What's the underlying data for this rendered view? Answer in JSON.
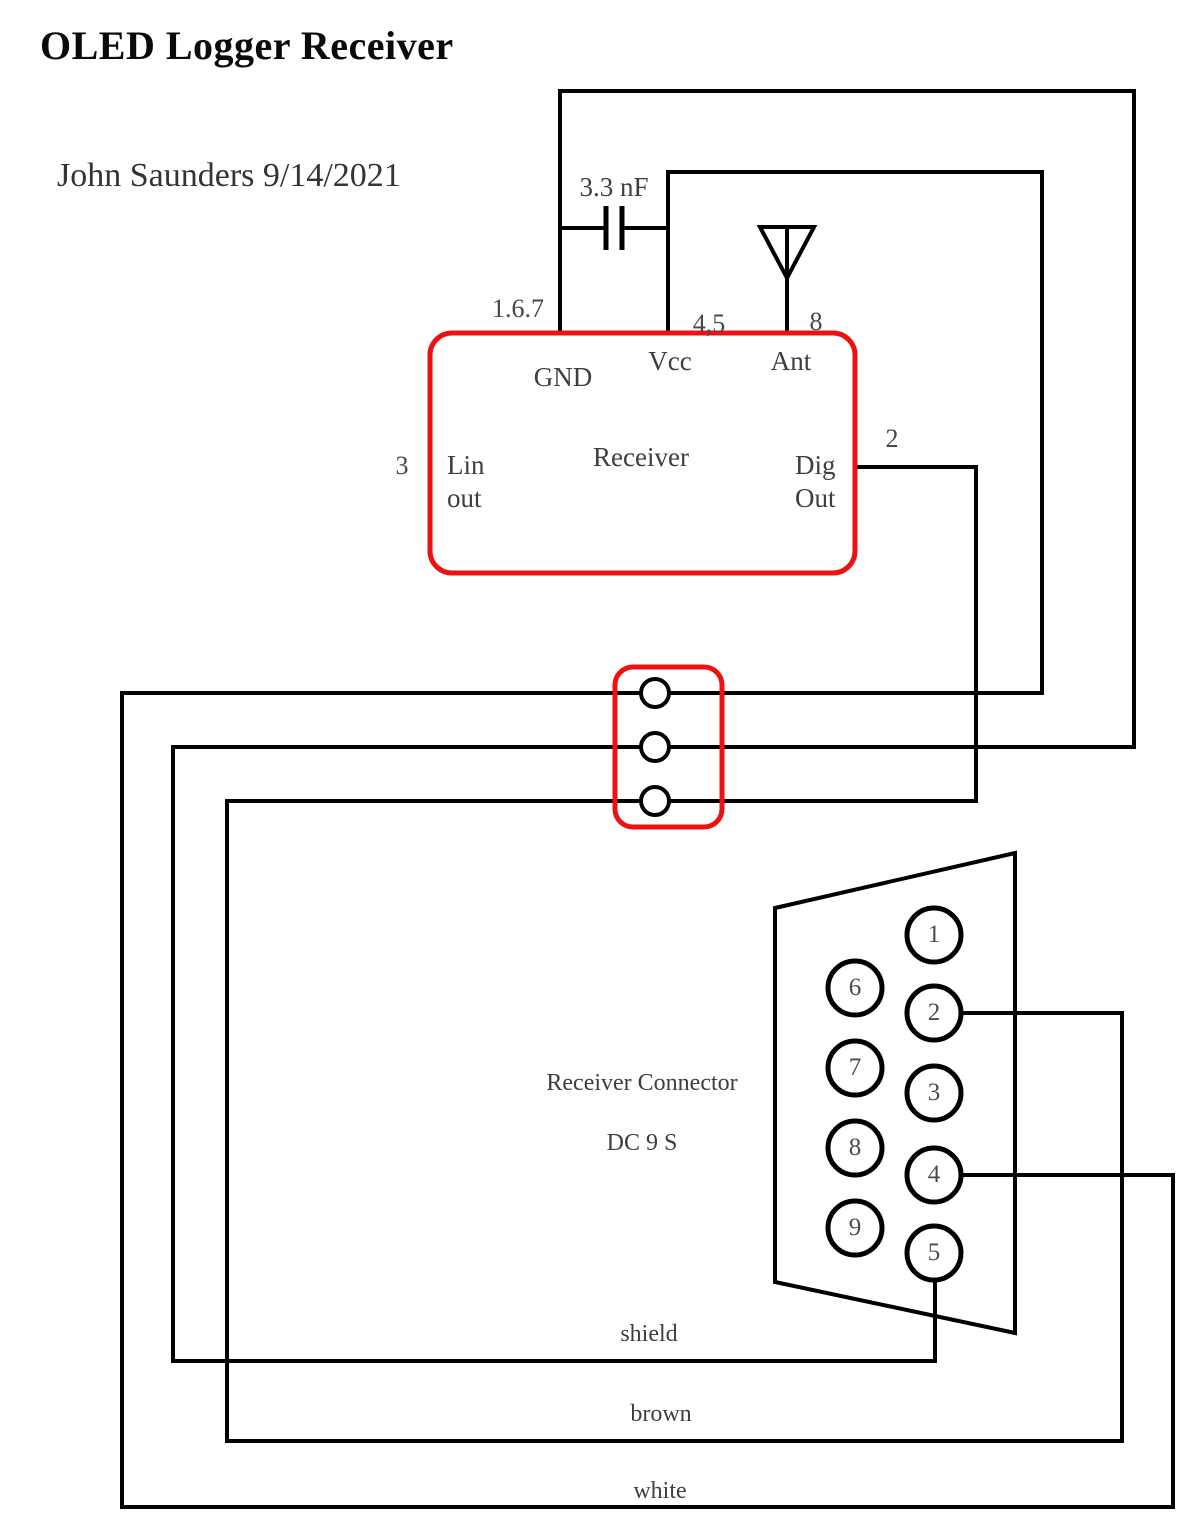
{
  "title": "OLED Logger Receiver",
  "byline": "John Saunders  9/14/2021",
  "capacitor": {
    "value": "3.3 nF"
  },
  "receiver": {
    "name": "Receiver",
    "pins": {
      "gnd": {
        "label": "GND",
        "numbers": "1.6.7"
      },
      "vcc": {
        "label": "Vcc",
        "numbers": "4,5"
      },
      "ant": {
        "label": "Ant",
        "numbers": "8"
      },
      "lin_out": {
        "label": "Lin\nout",
        "numbers": "3"
      },
      "dig_out": {
        "label": "Dig\nOut",
        "numbers": "2"
      }
    }
  },
  "connector": {
    "title_line1": "Receiver Connector",
    "title_line2": "DC 9 S",
    "pins": [
      "1",
      "2",
      "3",
      "4",
      "5",
      "6",
      "7",
      "8",
      "9"
    ]
  },
  "wire_labels": {
    "shield": "shield",
    "brown": "brown",
    "white": "white"
  },
  "colors": {
    "wire": "#000000",
    "component_outline": "#ee1111"
  }
}
